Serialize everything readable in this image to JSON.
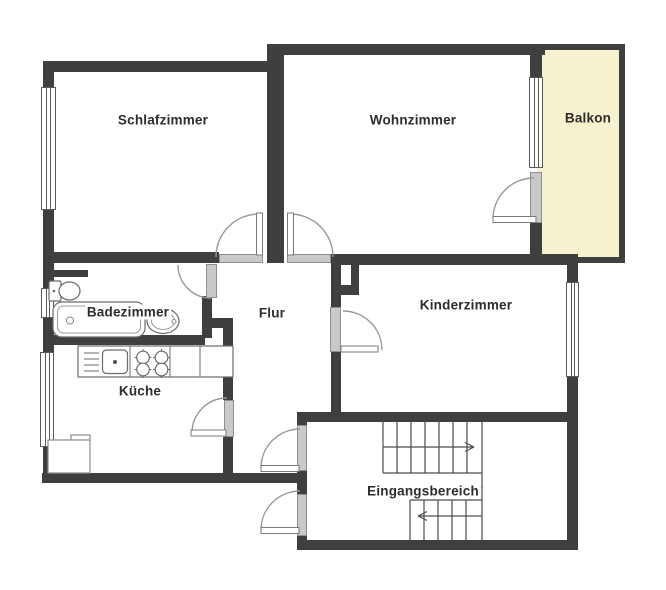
{
  "rooms": {
    "schlafzimmer": "Schlafzimmer",
    "wohnzimmer": "Wohnzimmer",
    "balkon": "Balkon",
    "badezimmer": "Badezimmer",
    "flur": "Flur",
    "kinderzimmer": "Kinderzimmer",
    "kueche": "Küche",
    "eingangsbereich": "Eingangsbereich"
  },
  "colors": {
    "wall": "#3f3f3f",
    "balcony_fill": "#f6f1cf",
    "door_threshold": "#c9c9c9",
    "swing_line": "#979797",
    "text": "#2d2d2d",
    "background": "#ffffff"
  },
  "stairs": {
    "upper_flight_arrow": "right",
    "lower_flight_arrow": "left"
  },
  "icons": {
    "toilet-icon": "toilet with cistern, bathroom",
    "bathtub-icon": "bathtub with drain, bathroom",
    "sink-icon": "oval washbasin, bathroom",
    "kitchen-counter-icon": "counter row with sink and stove",
    "stove-icon": "four burner cooktop",
    "stairs-icon": "staircase with direction arrows"
  }
}
